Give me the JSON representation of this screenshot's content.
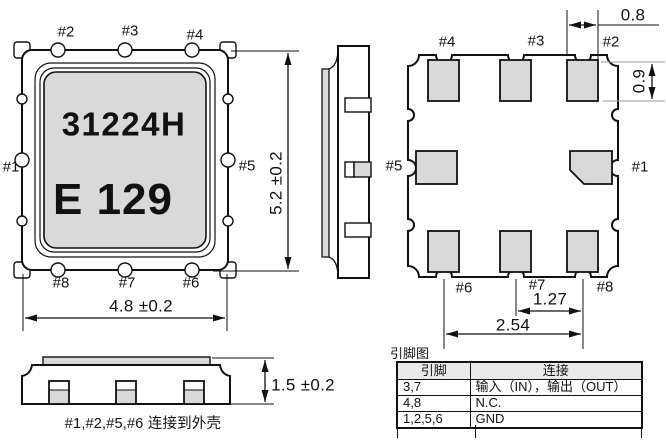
{
  "drawing": {
    "pin_labels": {
      "p1": "#1",
      "p2": "#2",
      "p3": "#3",
      "p4": "#4",
      "p5": "#5",
      "p6": "#6",
      "p7": "#7",
      "p8": "#8"
    },
    "top_view": {
      "marking_line1": "31224H",
      "marking_line2": "E 129",
      "dim_width": "4.8 ±0.2",
      "dim_height": "5.2 ±0.2"
    },
    "bottom_view": {
      "dim_pad_width": "0.8",
      "dim_pad_height": "0.9",
      "dim_pitch": "1.27",
      "dim_span": "2.54"
    },
    "front_view": {
      "dim_height": "1.5 ±0.2"
    },
    "note": "#1,#2,#5,#6  连接到外壳",
    "pin_table": {
      "title": "引脚图",
      "headers": [
        "引脚",
        "连接"
      ],
      "rows": [
        [
          "3,7",
          "输入（IN），输出（OUT）"
        ],
        [
          "4,8",
          "N.C."
        ],
        [
          "1,2,5,6",
          "GND"
        ]
      ]
    }
  },
  "colors": {
    "line": "#111111",
    "pad_gray": "#d9d9d9",
    "lid_gray": "#d9d9d9",
    "table_header_bg": "#e9e9e9"
  }
}
